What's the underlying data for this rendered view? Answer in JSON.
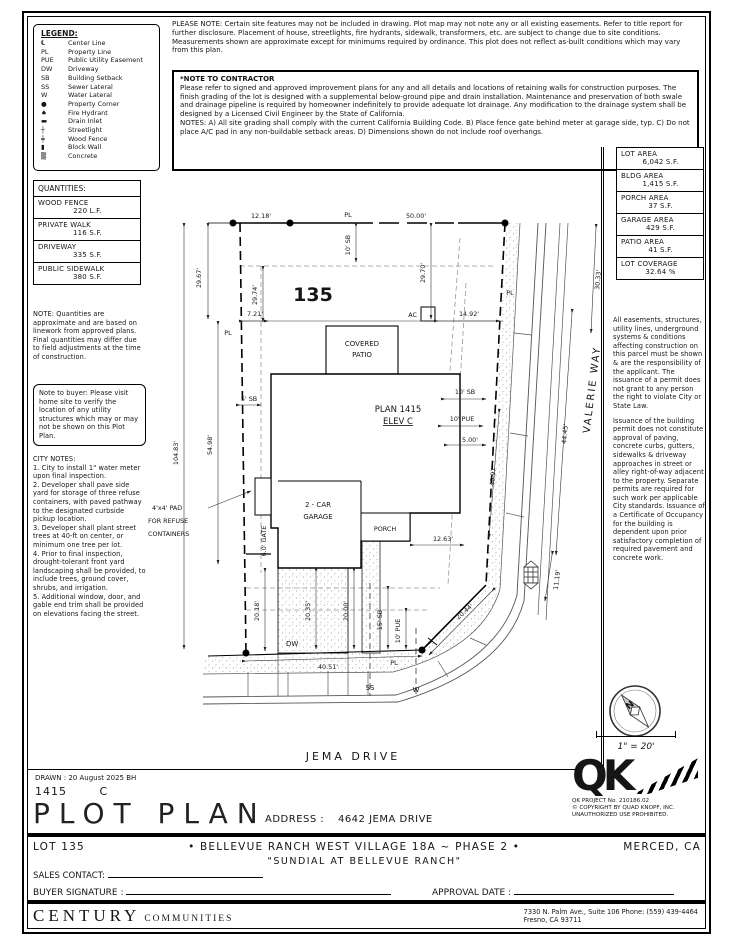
{
  "legend": {
    "title": "LEGEND:",
    "items": [
      {
        "sym": "℄",
        "label": "Center Line"
      },
      {
        "sym": "PL",
        "label": "Property Line"
      },
      {
        "sym": "PUE",
        "label": "Public Utility Easement"
      },
      {
        "sym": "DW",
        "label": "Driveway"
      },
      {
        "sym": "SB",
        "label": "Building Setback"
      },
      {
        "sym": "SS",
        "label": "Sewer Lateral"
      },
      {
        "sym": "W",
        "label": "Water Lateral"
      },
      {
        "sym": "●",
        "label": "Property Corner"
      },
      {
        "sym": "♠",
        "label": "Fire Hydrant"
      },
      {
        "sym": "▬",
        "label": "Drain Inlet"
      },
      {
        "sym": "┼",
        "label": "Streetlight"
      },
      {
        "sym": "╪",
        "label": "Wood Fence"
      },
      {
        "sym": "▮",
        "label": "Block Wall"
      },
      {
        "sym": "▒",
        "label": "Concrete"
      }
    ]
  },
  "please_note": "PLEASE NOTE:  Certain site features may not be included in drawing. Plot map may not note any or all existing easements. Refer to title report for further disclosure. Placement of house, streetlights, fire hydrants, sidewalk, transformers, etc. are subject to change due to site conditions. Measurements shown are approximate except for minimums required by ordinance. This plot does not reflect as-built conditions which may vary from this plan.",
  "contractor_note": {
    "title": "*NOTE TO CONTRACTOR",
    "body": "Please refer to signed and approved improvement plans for any and all details and locations of retaining walls for construction purposes. The finish grading of the lot is designed with a supplemental below-ground pipe and drain installation. Maintenance and preservation of both swale and drainage pipeline is required by homeowner indefinitely to provide adequate lot drainage. Any modification to the drainage system shall be designed by a Licensed Civil Engineer by the State of California.",
    "notes": "NOTES:  A) All site grading shall comply with the current California Building Code.  B) Place fence gate behind meter at garage side, typ. C) Do not place A/C pad in any non-buildable setback areas.  D) Dimensions shown do not include roof overhangs."
  },
  "areas": {
    "rows": [
      {
        "label": "LOT AREA",
        "value": "6,042 S.F."
      },
      {
        "label": "BLDG AREA",
        "value": "1,415 S.F."
      },
      {
        "label": "PORCH AREA",
        "value": "37 S.F."
      },
      {
        "label": "GARAGE AREA",
        "value": "429 S.F."
      },
      {
        "label": "PATIO AREA",
        "value": "41 S.F."
      },
      {
        "label": "LOT COVERAGE",
        "value": "32.64 %"
      }
    ]
  },
  "quantities": {
    "title": "QUANTITIES:",
    "rows": [
      {
        "label": "WOOD FENCE",
        "value": "220 L.F."
      },
      {
        "label": "PRIVATE WALK",
        "value": "116 S.F."
      },
      {
        "label": "DRIVEWAY",
        "value": "335 S.F."
      },
      {
        "label": "PUBLIC SIDEWALK",
        "value": "380 S.F."
      }
    ],
    "note": "NOTE: Quantities are approximate and are based on linework from approved plans.  Final quantities may differ due to field adjustments at the time of construction."
  },
  "buyer_note": "Note to buyer: Please visit home site to verify the location of any utility structures which may or may not be shown on this Plot Plan.",
  "city_notes": {
    "title": "CITY NOTES:",
    "items": [
      "1. City to install 1\" water meter upon final inspection.",
      "2. Developer shall pave side yard for storage of three refuse containers, with paved pathway to the designated curbside pickup location.",
      "3. Developer shall plant street trees at 40-ft on center, or minimum one tree per lot.",
      "4. Prior to final inspection, drought-tolerant front yard landscaping shall be provided, to include trees, ground cover, shrubs, and irrigation.",
      "5. Additional window, door, and gable end trim shall be provided on elevations facing the street."
    ]
  },
  "right_notes": {
    "p1": "All easements, structures, utility lines, underground systems & conditions affecting construction on this parcel must be shown & are the responsibility of the applicant. The issuance of a permit does not grant to any person the right to violate City or State Law.",
    "p2": "Issuance of the building permit does not constitute approval of paving, concrete curbs, gutters, sidewalks & driveway approaches in street or alley right-of-way adjacent to the property. Separate permits are required for such work per applicable City standards. Issuance of a Certificate of Occupancy for the building is dependent upon prior satisfactory completion of required pavement and concrete work."
  },
  "plot": {
    "lot_number": "135",
    "plan": "PLAN 1415",
    "elev": "ELEV C",
    "patio1": "COVERED",
    "patio2": "PATIO",
    "garage1": "2 - CAR",
    "garage2": "GARAGE",
    "porch": "PORCH",
    "ac": "AC",
    "dw": "DW",
    "gate": "6.0' GATE",
    "pad1": "4'x4' PAD",
    "pad2": "FOR REFUSE",
    "pad3": "CONTAINERS",
    "pl": "PL",
    "ss": "SS",
    "w": "W",
    "jema": "JEMA DRIVE",
    "valerie": "VALERIE WAY",
    "dims": {
      "d12_18": "12.18'",
      "d50_00": "50.00'",
      "d29_67": "29.67'",
      "d29_74": "29.74'",
      "d29_70": "29.70'",
      "d30_33": "30.33'",
      "d7_21": "7.21'",
      "d14_92": "14.92'",
      "d54_98": "54.98'",
      "d104_83": "104.83'",
      "d44_45": "44.45'",
      "d40_97": "40.97'",
      "d5_00": "5.00'",
      "d12_63": "12.63'",
      "d20_44": "20.44'",
      "d20_18": "20.18'",
      "d20_35": "20.35'",
      "d20_00": "20.00'",
      "d40_51": "40.51'",
      "d11_19": "11.19'",
      "sb10_top": "10' SB",
      "sb5_left": "5' SB",
      "sb10_right": "10' SB",
      "pue10_right": "10' PUE",
      "sb15_front": "15' SB",
      "pue10_front": "10' PUE"
    }
  },
  "compass": {
    "n": "N"
  },
  "scale_text": "1\" = 20'",
  "qk": {
    "logo": "QK",
    "project": "QK PROJECT No. 210186.02",
    "copyright": "© COPYRIGHT BY QUAD KNOPF, INC.",
    "rights": "UNAUTHORIZED USE PROHIBITED."
  },
  "title_block": {
    "drawn": "DRAWN :  20 August 2025  BH",
    "plan_code": "1415",
    "elev_code": "C",
    "title": "PLOT PLAN",
    "address_label": "ADDRESS :",
    "address": "4642 JEMA DRIVE"
  },
  "footer": {
    "lot": "LOT 135",
    "subdivision": "•     BELLEVUE RANCH WEST VILLAGE 18A ~ PHASE 2     •",
    "city": "MERCED, CA",
    "community": "\"SUNDIAL AT BELLEVUE RANCH\"",
    "sales_contact": "SALES CONTACT:",
    "buyer_signature": "BUYER SIGNATURE :",
    "approval_date": "APPROVAL DATE :",
    "brand_main": "CENTURY",
    "brand_sub": "COMMUNITIES",
    "addr_line1": "7330 N. Palm Ave., Suite 106    Phone:  (559) 439-4464",
    "addr_line2": "Fresno, CA  93711"
  }
}
